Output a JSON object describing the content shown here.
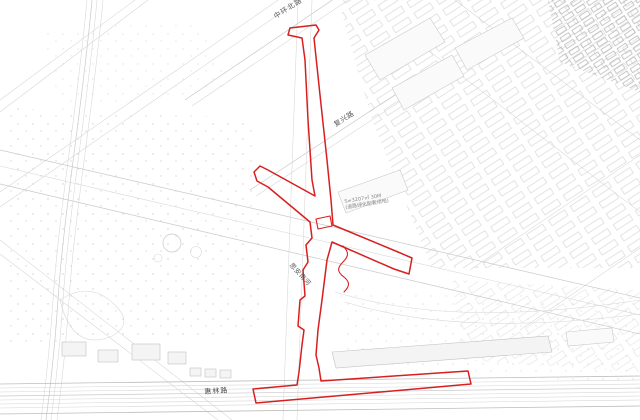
{
  "map": {
    "labels": {
      "road_top": "中环北路",
      "road_mid": "复兴路",
      "river": "思安南河",
      "road_bottom": "惠林路",
      "annotation_line1": "S=3207㎡ 30M",
      "annotation_line2": "(道路绿化配套用地)"
    },
    "colors": {
      "route_red": "#d81f1f",
      "line_gray": "#c9c9c9",
      "text_gray": "#5a5a5a",
      "background": "#ffffff"
    }
  }
}
